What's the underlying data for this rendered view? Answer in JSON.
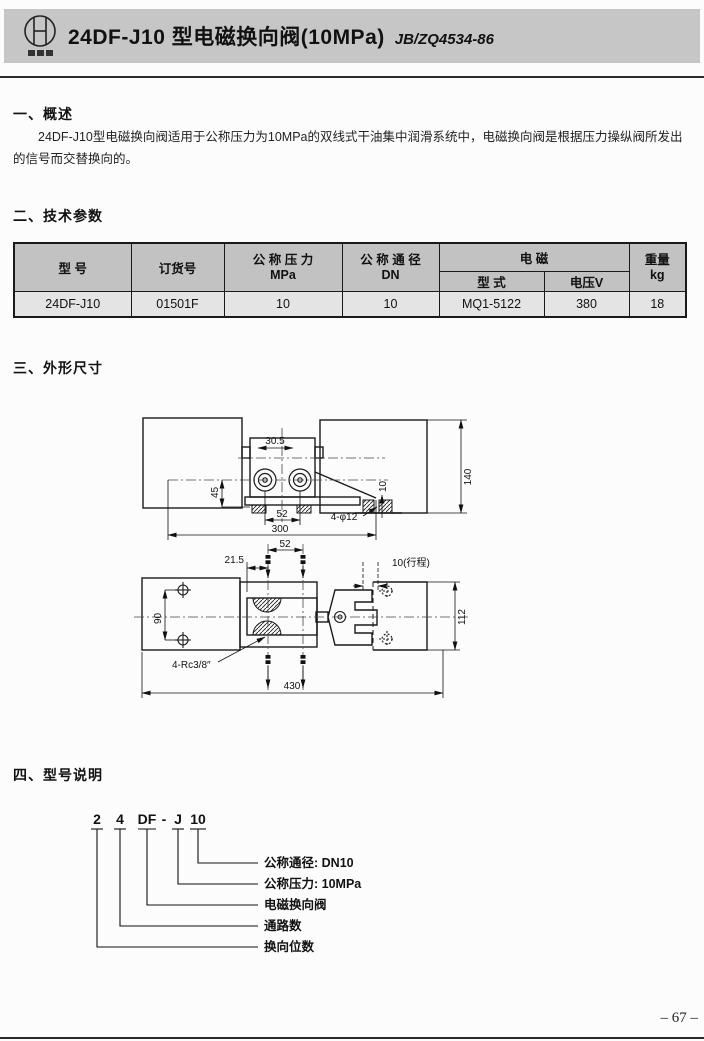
{
  "header": {
    "title": "24DF-J10 型电磁换向阀(10MPa)",
    "standard": "JB/ZQ4534-86"
  },
  "overview": {
    "heading": "一、概述",
    "body": "24DF-J10型电磁换向阀适用于公称压力为10MPa的双线式干油集中润滑系统中，电磁换向阀是根据压力操纵阀所发出的信号而交替换向的。"
  },
  "parameters": {
    "heading": "二、技术参数",
    "table": {
      "col_model": "型  号",
      "col_order": "订货号",
      "col_pressure_l1": "公 称 压 力",
      "col_pressure_l2": "MPa",
      "col_diameter_l1": "公 称 通 径",
      "col_diameter_l2": "DN",
      "col_solenoid": "电  磁",
      "col_solenoid_type": "型 式",
      "col_voltage": "电压V",
      "col_weight_l1": "重量",
      "col_weight_l2": "kg",
      "row": {
        "model": "24DF-J10",
        "order_no": "01501F",
        "pressure": "10",
        "diameter": "10",
        "solenoid_type": "MQ1-5122",
        "voltage": "380",
        "weight": "18"
      }
    }
  },
  "dimensions": {
    "heading": "三、外形尺寸",
    "front_view": {
      "dim_top_width": "30.5",
      "dim_port_height": "45",
      "dim_port_spacing": "52",
      "dim_base_width": "300",
      "dim_height": "140",
      "dim_base_thickness": "10",
      "hole_callout": "4-φ12"
    },
    "top_view": {
      "dim_port_spacing": "52",
      "dim_port_offset": "21.5",
      "stroke_callout": "10(行程)",
      "dim_mount_spacing": "90",
      "dim_height": "112",
      "thread_callout": "4-Rc3/8″",
      "dim_overall_length": "430"
    }
  },
  "model_code": {
    "heading": "四、型号说明",
    "segments": [
      "2",
      "4",
      "DF",
      "-",
      "J",
      "10"
    ],
    "labels": [
      "公称通径: DN10",
      "公称压力: 10MPa",
      "电磁换向阀",
      "通路数",
      "换向位数"
    ]
  },
  "page": {
    "number": "– 67 –"
  }
}
